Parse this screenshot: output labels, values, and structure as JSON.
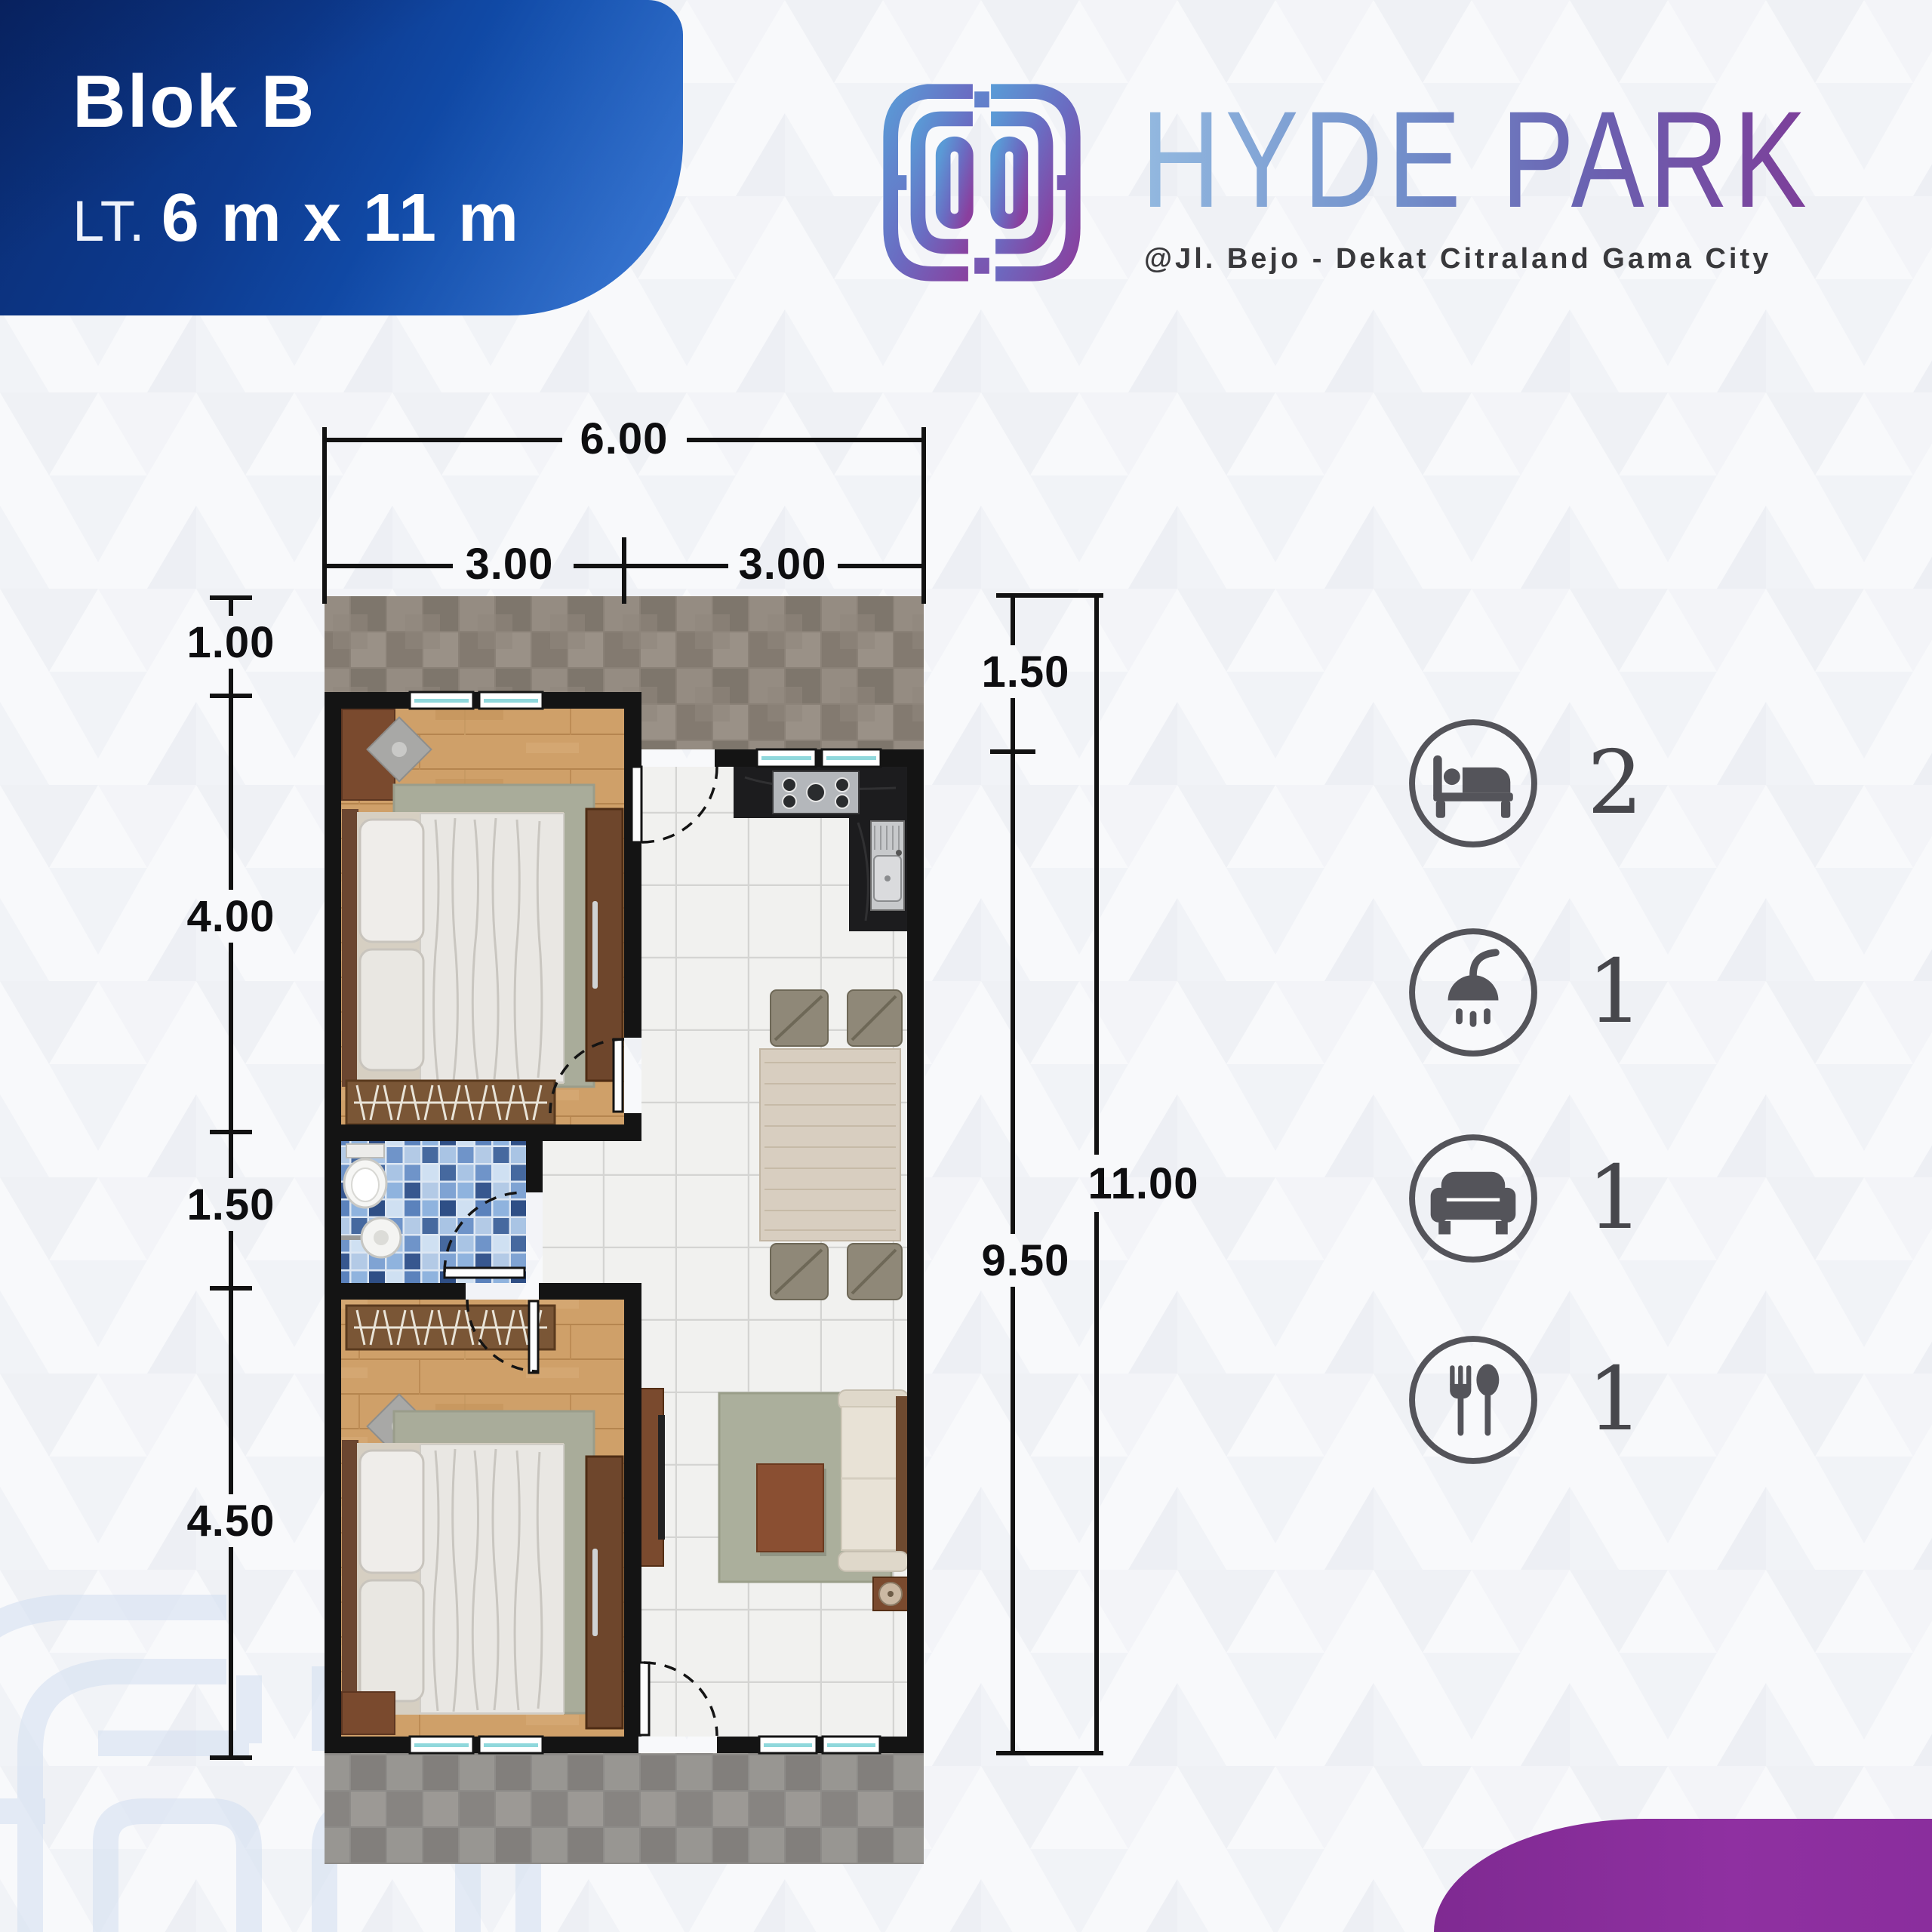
{
  "badge": {
    "block_label": "Blok B",
    "lot_prefix": "LT.",
    "lot_size": "6 m x 11 m"
  },
  "brand": {
    "name": "HYDE PARK",
    "tagline": "@Jl. Bejo - Dekat Citraland Gama City",
    "logo_icon": "maze-h-logo",
    "gradient_start": "#93b9e0",
    "gradient_end": "#7d3e99"
  },
  "floor_plan": {
    "dimensions": {
      "top_total": "6.00",
      "top_left": "3.00",
      "top_right": "3.00",
      "left_side": [
        "1.00",
        "4.00",
        "1.50",
        "4.50"
      ],
      "right_upper": "1.50",
      "right_lower": "9.50",
      "right_total": "11.00"
    }
  },
  "features": [
    {
      "name": "bedrooms",
      "icon": "bed-icon",
      "count": "2"
    },
    {
      "name": "bathrooms",
      "icon": "shower-icon",
      "count": "1"
    },
    {
      "name": "living-rooms",
      "icon": "sofa-icon",
      "count": "1"
    },
    {
      "name": "dining-rooms",
      "icon": "cutlery-icon",
      "count": "1"
    }
  ],
  "colors": {
    "badge_blue_dark": "#0a2c72",
    "badge_blue_light": "#1e66d0",
    "accent_purple": "#8a2e9d",
    "icon_gray": "#54545a",
    "dimension_black": "#121212"
  }
}
